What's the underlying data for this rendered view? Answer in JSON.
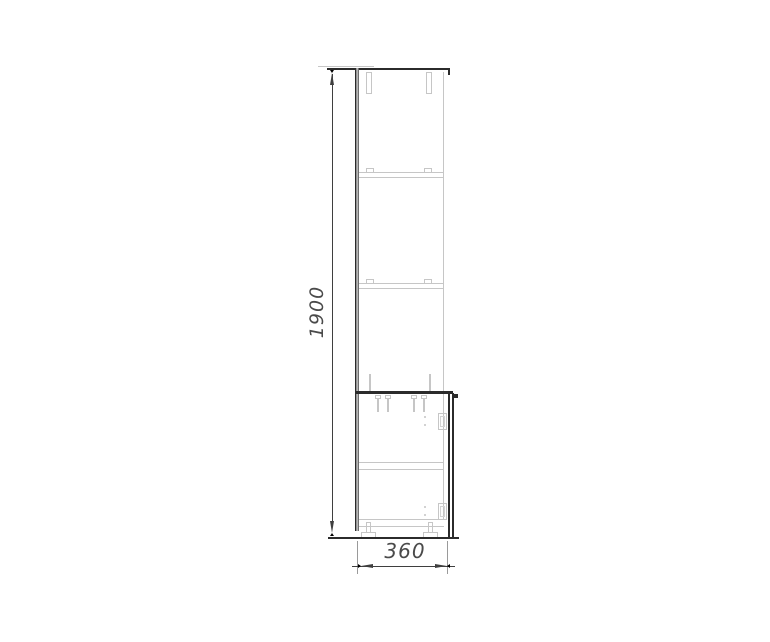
{
  "colors": {
    "outline": "#2b2b2b",
    "hidden": "#c6c6c6",
    "dimension": "#3f3f3f",
    "label": "#4a4a4a",
    "background": "#ffffff"
  },
  "dimensions": {
    "height": {
      "label": "1900"
    },
    "depth": {
      "label": "360"
    }
  }
}
